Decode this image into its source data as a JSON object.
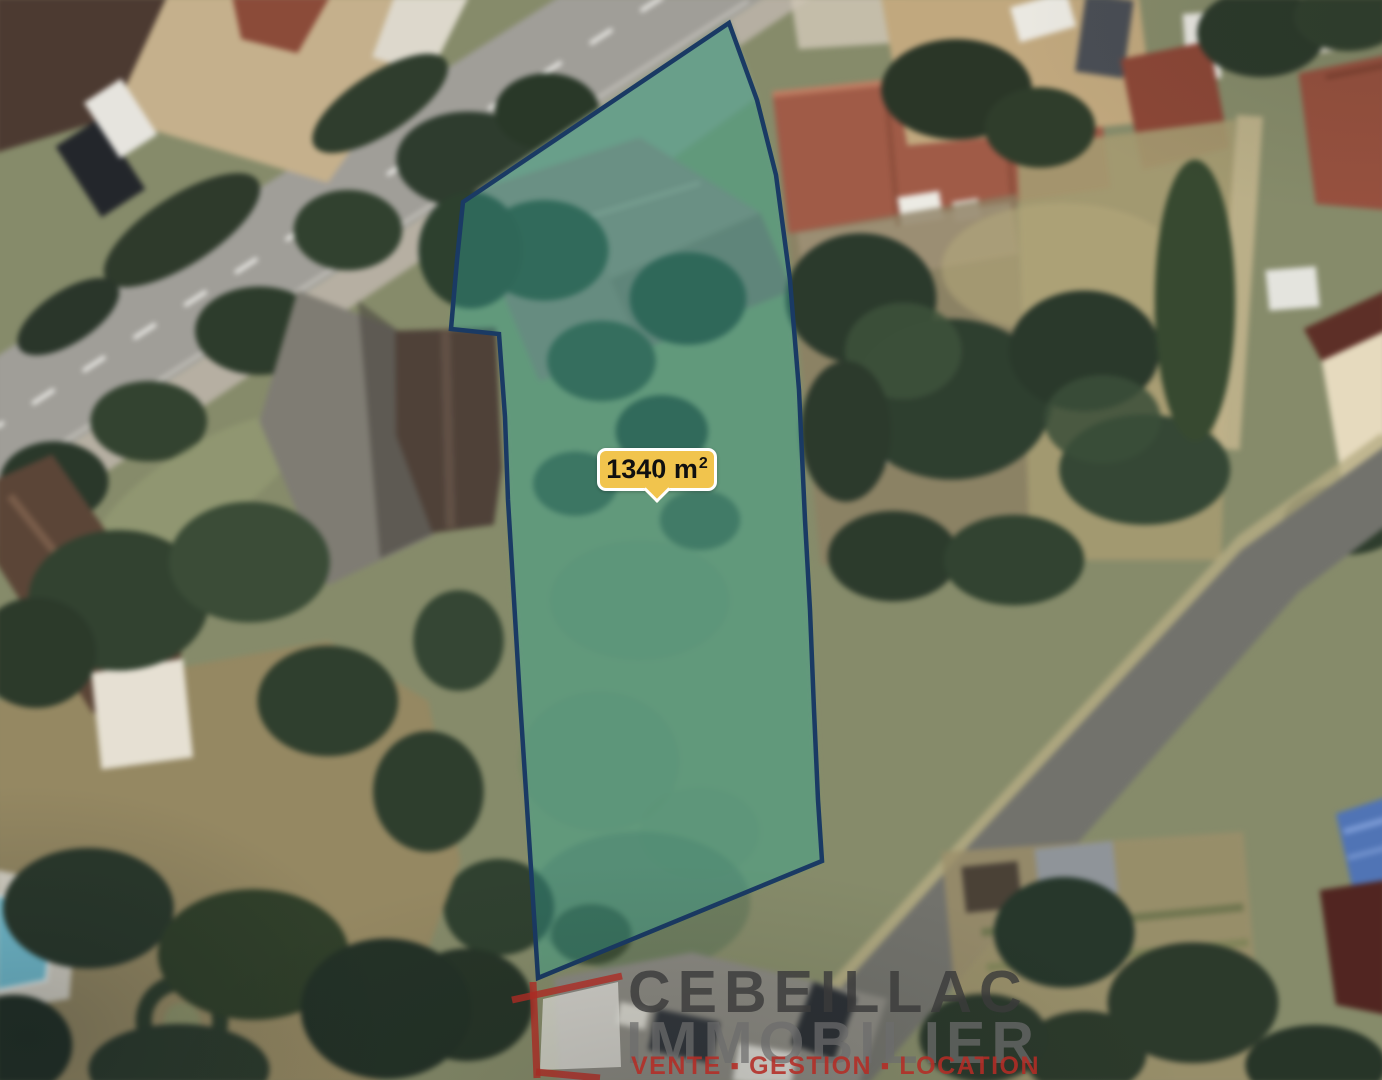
{
  "map": {
    "parcel": {
      "area_value": "1340 m",
      "area_sup": "2",
      "outline_color": "#1a3a64",
      "fill_color": "rgba(52,168,159,0.38)"
    },
    "area_label": {
      "background": "#f1c44d",
      "border_color": "#ffffff",
      "text_color": "#101010"
    }
  },
  "watermark": {
    "brand_line1": "CEBEILLAC",
    "brand_line2": "IMMOBILIER",
    "tagline": "VENTE ▪ GESTION ▪ LOCATION",
    "brand_color": "rgba(58,58,58,0.82)",
    "secondary_color": "rgba(108,108,108,0.72)",
    "tagline_color": "rgba(180,44,38,0.88)",
    "icon_color": "rgba(185,45,38,0.8)"
  }
}
